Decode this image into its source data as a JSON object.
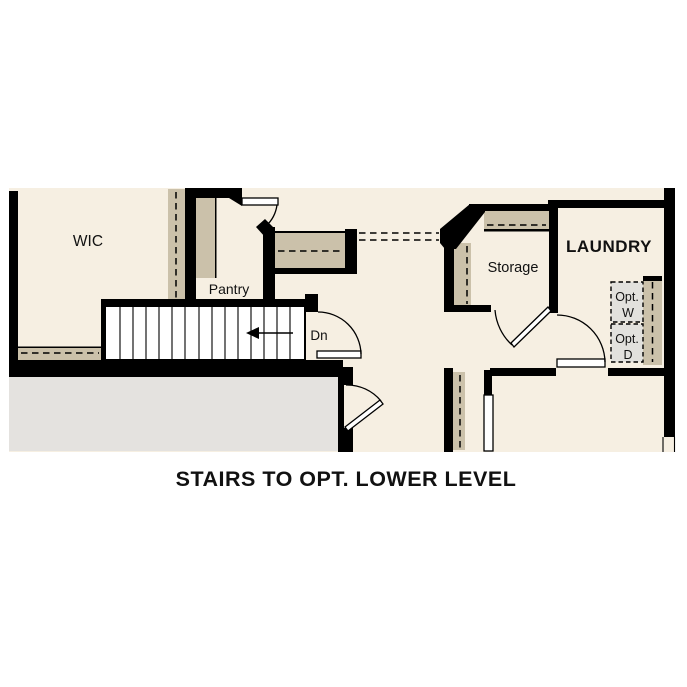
{
  "title": "STAIRS TO OPT. LOWER LEVEL",
  "rooms": {
    "wic": "WIC",
    "pantry": "Pantry",
    "storage": "Storage",
    "laundry": "LAUNDRY"
  },
  "stairs": {
    "direction_label": "Dn"
  },
  "optional_appliances": {
    "washer_line1": "Opt.",
    "washer_line2": "W",
    "dryer_line1": "Opt.",
    "dryer_line2": "D"
  },
  "colors": {
    "background": "#FFFFFF",
    "floor": "#F6EFE2",
    "walls": "#000000",
    "wall_shading": "#CBC1AA",
    "lower_area": "#E4E2DF",
    "optional_appliance_fill": "#E2E1DD",
    "text": "#111111"
  }
}
